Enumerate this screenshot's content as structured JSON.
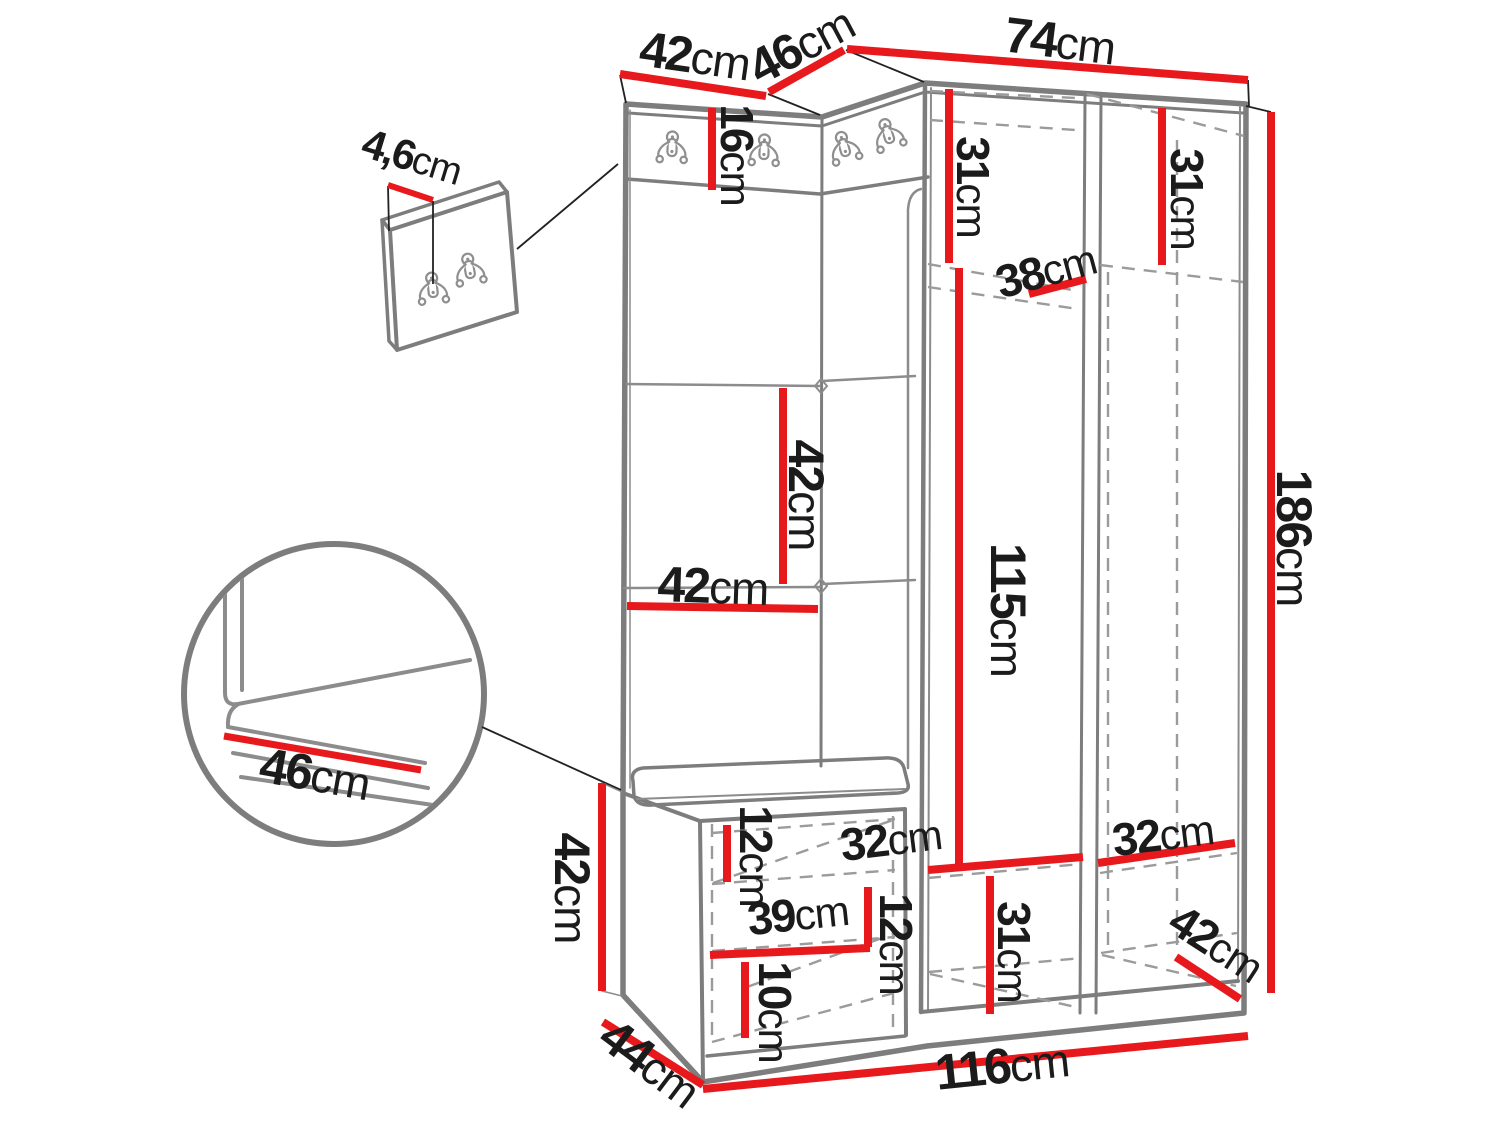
{
  "figure": {
    "type": "furniture-dimension-diagram",
    "subject": "Hallway wardrobe set with coat-hook strip, upholstered panels, shoe bench and wall hook panel",
    "units": "cm",
    "colors": {
      "dimension_line": "#e8191c",
      "outline": "#7d7d7d",
      "dashed": "#9b9b9b",
      "text": "#1b1b1b",
      "background": "#ffffff"
    },
    "icons": {
      "coat_hook": "double-coat-hook-icon",
      "detail_circle": "bench-corner-detail",
      "wall_panel": "wall-hook-panel-detail"
    }
  },
  "dimensions": {
    "top_left_panel_width": {
      "value": "42",
      "unit": "cm"
    },
    "top_corner_width": {
      "value": "46",
      "unit": "cm"
    },
    "top_wardrobe_width": {
      "value": "74",
      "unit": "cm"
    },
    "hook_strip_height": {
      "value": "16",
      "unit": "cm"
    },
    "wall_panel_thickness": {
      "value": "4,6",
      "unit": "cm"
    },
    "wardrobe_left_top_shelf_height": {
      "value": "31",
      "unit": "cm"
    },
    "wardrobe_right_top_shelf_height": {
      "value": "31",
      "unit": "cm"
    },
    "wardrobe_shelf_depth": {
      "value": "38",
      "unit": "cm"
    },
    "panel_cushion_height": {
      "value": "42",
      "unit": "cm"
    },
    "panel_width": {
      "value": "42",
      "unit": "cm"
    },
    "hanging_space_height": {
      "value": "115",
      "unit": "cm"
    },
    "total_height": {
      "value": "186",
      "unit": "cm"
    },
    "bench_seat_depth_detail": {
      "value": "46",
      "unit": "cm"
    },
    "bench_height": {
      "value": "42",
      "unit": "cm"
    },
    "bench_depth": {
      "value": "44",
      "unit": "cm"
    },
    "bench_top_compartment_height": {
      "value": "12",
      "unit": "cm"
    },
    "bench_inner_width": {
      "value": "39",
      "unit": "cm"
    },
    "bench_right_compartment_height": {
      "value": "12",
      "unit": "cm"
    },
    "bench_bottom_compartment_height": {
      "value": "10",
      "unit": "cm"
    },
    "bottom_left_compartment_width": {
      "value": "32",
      "unit": "cm"
    },
    "bottom_right_compartment_width": {
      "value": "32",
      "unit": "cm"
    },
    "bottom_compartment_height": {
      "value": "31",
      "unit": "cm"
    },
    "bottom_compartment_depth": {
      "value": "42",
      "unit": "cm"
    },
    "total_width": {
      "value": "116",
      "unit": "cm"
    }
  }
}
